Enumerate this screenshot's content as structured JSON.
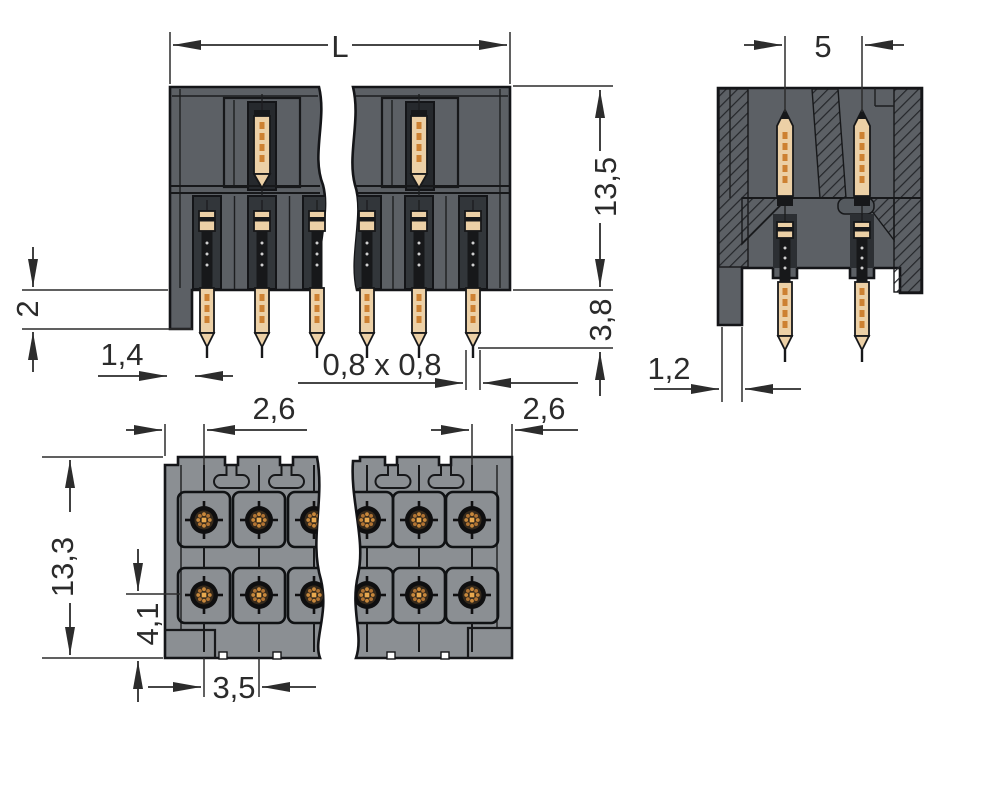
{
  "diagram": {
    "kind": "connector-dimensional-drawing",
    "view_count": 3
  },
  "colors": {
    "background": "#ffffff",
    "line": "#17181a",
    "dimension": "#2c2c2c",
    "body_dark": "#5c6065",
    "body_light": "#8b8f93",
    "channel": "#32363a",
    "pin_tan": "#ecd0a6",
    "pin_orange": "#cd8132",
    "hole_dot": "#c8883c"
  },
  "views": {
    "front": {
      "dim_length": "L",
      "dim_height": "13,5",
      "dim_pin_protrusion": "3,8",
      "dim_tab_height": "2",
      "dim_tab_width": "1,4",
      "dim_pin_cross_section": "0,8 x 0,8"
    },
    "side": {
      "dim_row_pitch": "5",
      "dim_tab_width": "1,2"
    },
    "bottom": {
      "dim_edge_to_hole_left": "2,6",
      "dim_edge_to_hole_right": "2,6",
      "dim_height": "13,3",
      "dim_hole_row_offset": "4,1",
      "dim_pin_pitch": "3,5"
    }
  }
}
